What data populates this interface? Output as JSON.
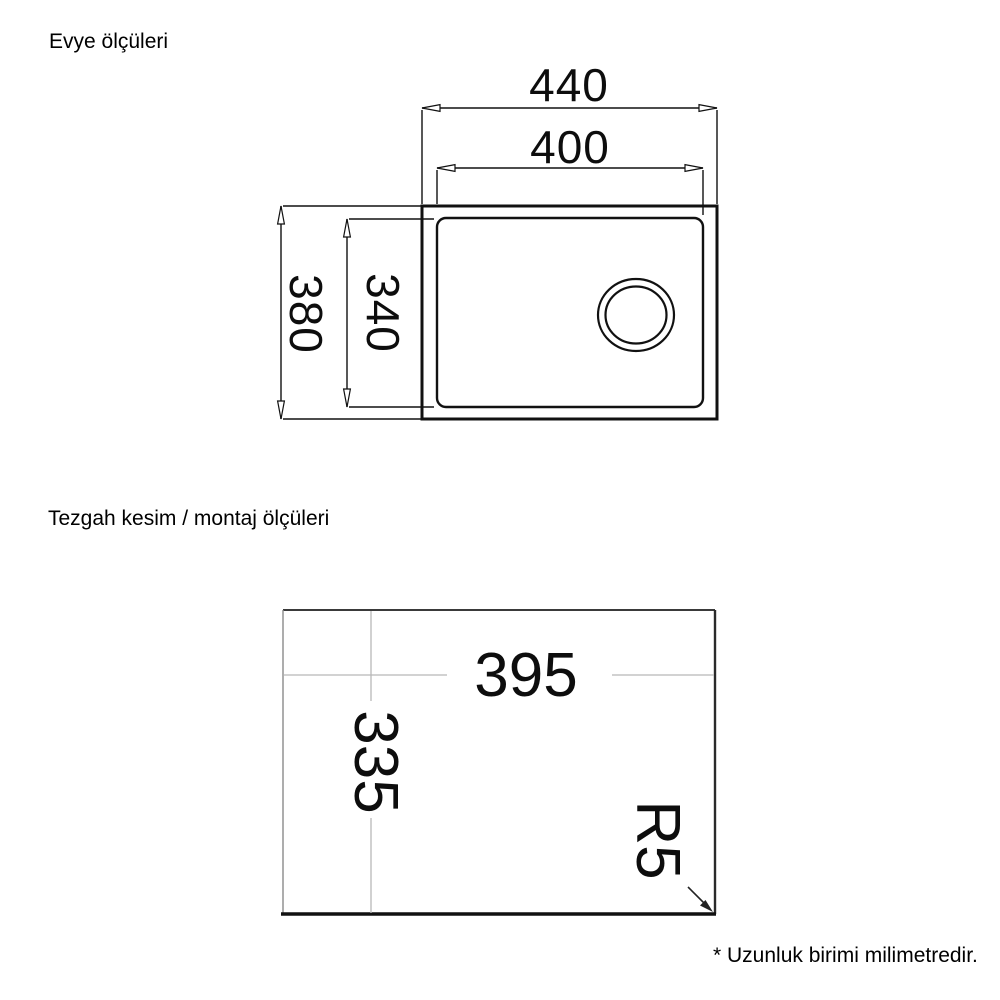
{
  "page": {
    "background": "#ffffff",
    "ink_color": "#1a1a1a",
    "light_line_color": "#b8b8b8"
  },
  "sink_section": {
    "title": "Evye ölçüleri",
    "dimensions": {
      "outer_width": "440",
      "inner_width": "400",
      "outer_height": "380",
      "inner_height": "340"
    }
  },
  "cutout_section": {
    "title": "Tezgah kesim / montaj ölçüleri",
    "dimensions": {
      "cut_width": "395",
      "cut_height": "335",
      "corner_radius": "R5"
    }
  },
  "footnote": "* Uzunluk birimi milimetredir."
}
